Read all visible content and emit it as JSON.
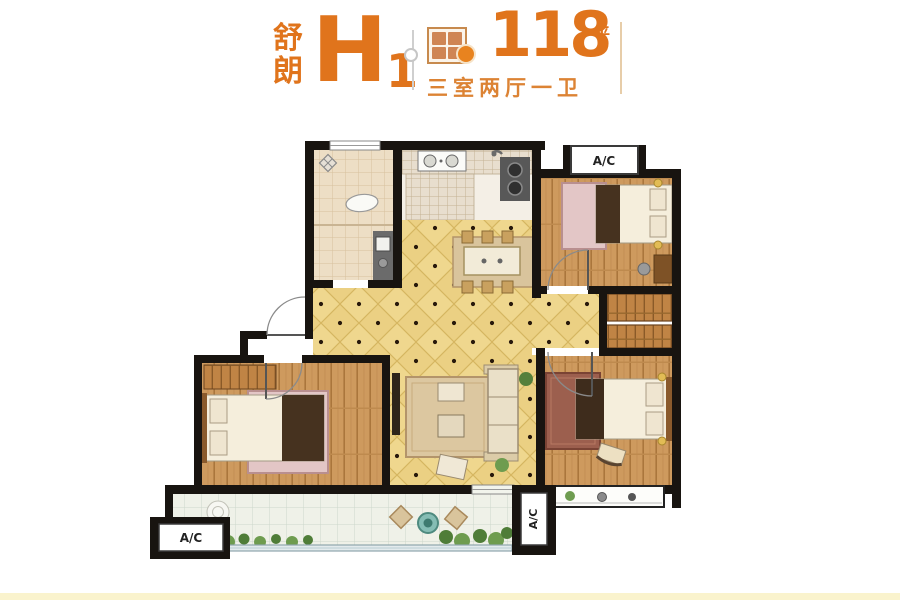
{
  "header": {
    "series_name_top": "舒",
    "series_name_bottom": "朗",
    "unit_letter": "H",
    "unit_number": "1",
    "area_value": "118",
    "area_unit": "平",
    "layout_description": "三室两厅一卫",
    "accent_color": "#E0741C"
  },
  "floorplan": {
    "ac_top_label": "A/C",
    "ac_left_label": "A/C",
    "ac_right_label": "A/C",
    "colors": {
      "wall": "#181410",
      "hall_tile": "#EBD083",
      "wood_floor": "#CE9A5E",
      "bathroom_tile": "#EDDEC5",
      "balcony_floor": "#EFF1E8",
      "plant_green": "#55803C",
      "rug_tan": "#DCC7A0",
      "rug_pink": "#E3C6C6",
      "rug_red": "#9C5F4E"
    }
  },
  "footer": {
    "strip_color": "#FAF3CD"
  }
}
